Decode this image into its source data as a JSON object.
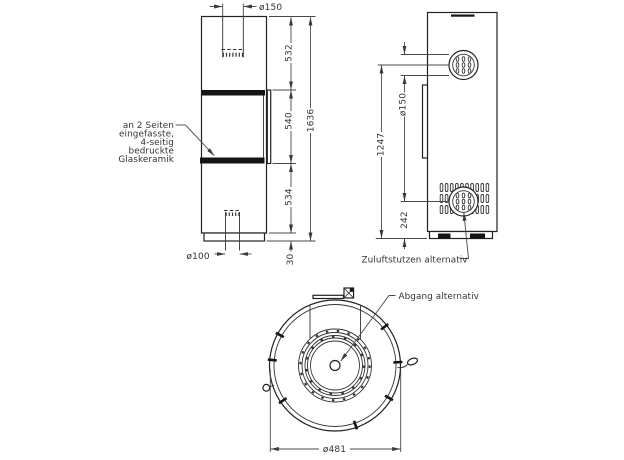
{
  "colors": {
    "object_line": "#222222",
    "dimension_line": "#484848",
    "text": "#333333",
    "black_fill": "#151515",
    "background": "#ffffff"
  },
  "front_view": {
    "dims": {
      "top_flue_diameter": "ø150",
      "top_section": "532",
      "firebox_section": "540",
      "bottom_section": "534",
      "plinth_height": "30",
      "total_height": "1636",
      "bottom_flue_diameter": "ø100"
    },
    "glass_note_lines": [
      "an 2 Seiten",
      "eingefasste,",
      "4-seitig",
      "bedruckte",
      "Glaskeramik"
    ]
  },
  "side_view": {
    "dims": {
      "outlet_diameter": "ø150",
      "outlet_center_height": "1247",
      "intake_center_height": "242"
    },
    "labels": {
      "zuluft": "Zuluftstutzen alternativ"
    }
  },
  "top_view": {
    "dims": {
      "outer_diameter": "ø481"
    },
    "labels": {
      "abgang": "Abgang alternativ"
    }
  }
}
